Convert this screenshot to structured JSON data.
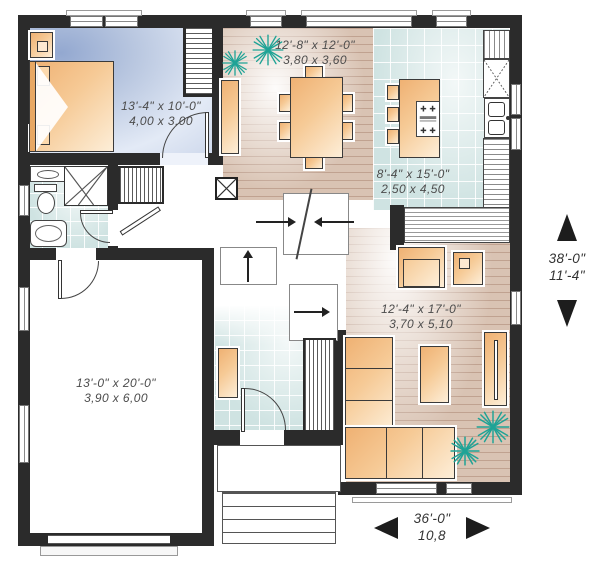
{
  "rooms": {
    "bedroom": {
      "imperial": "13'-4\" x 10'-0\"",
      "metric": "4,00 x 3,00"
    },
    "dining": {
      "imperial": "12'-8\" x 12'-0\"",
      "metric": "3,80 x 3,60"
    },
    "kitchen": {
      "imperial": "8'-4\" x 15'-0\"",
      "metric": "2,50 x 4,50"
    },
    "living": {
      "imperial": "12'-4\" x 17'-0\"",
      "metric": "3,70 x 5,10"
    },
    "garage": {
      "imperial": "13'-0\" x 20'-0\"",
      "metric": "3,90 x 6,00"
    }
  },
  "overall_dimensions": {
    "depth": {
      "imperial": "38'-0\"",
      "metric": "11'-4\""
    },
    "width": {
      "imperial": "36'-0\"",
      "metric": "10,8"
    }
  },
  "colors": {
    "wall": "#2b2b2b",
    "furniture_accent": "#f5c08a",
    "tile_floor": "#cfe3e2",
    "wood_floor": "#d9c3b3",
    "bedroom_floor": "#b9c7e0",
    "plant": "#1fa396",
    "label_text": "#4c4c4c"
  }
}
